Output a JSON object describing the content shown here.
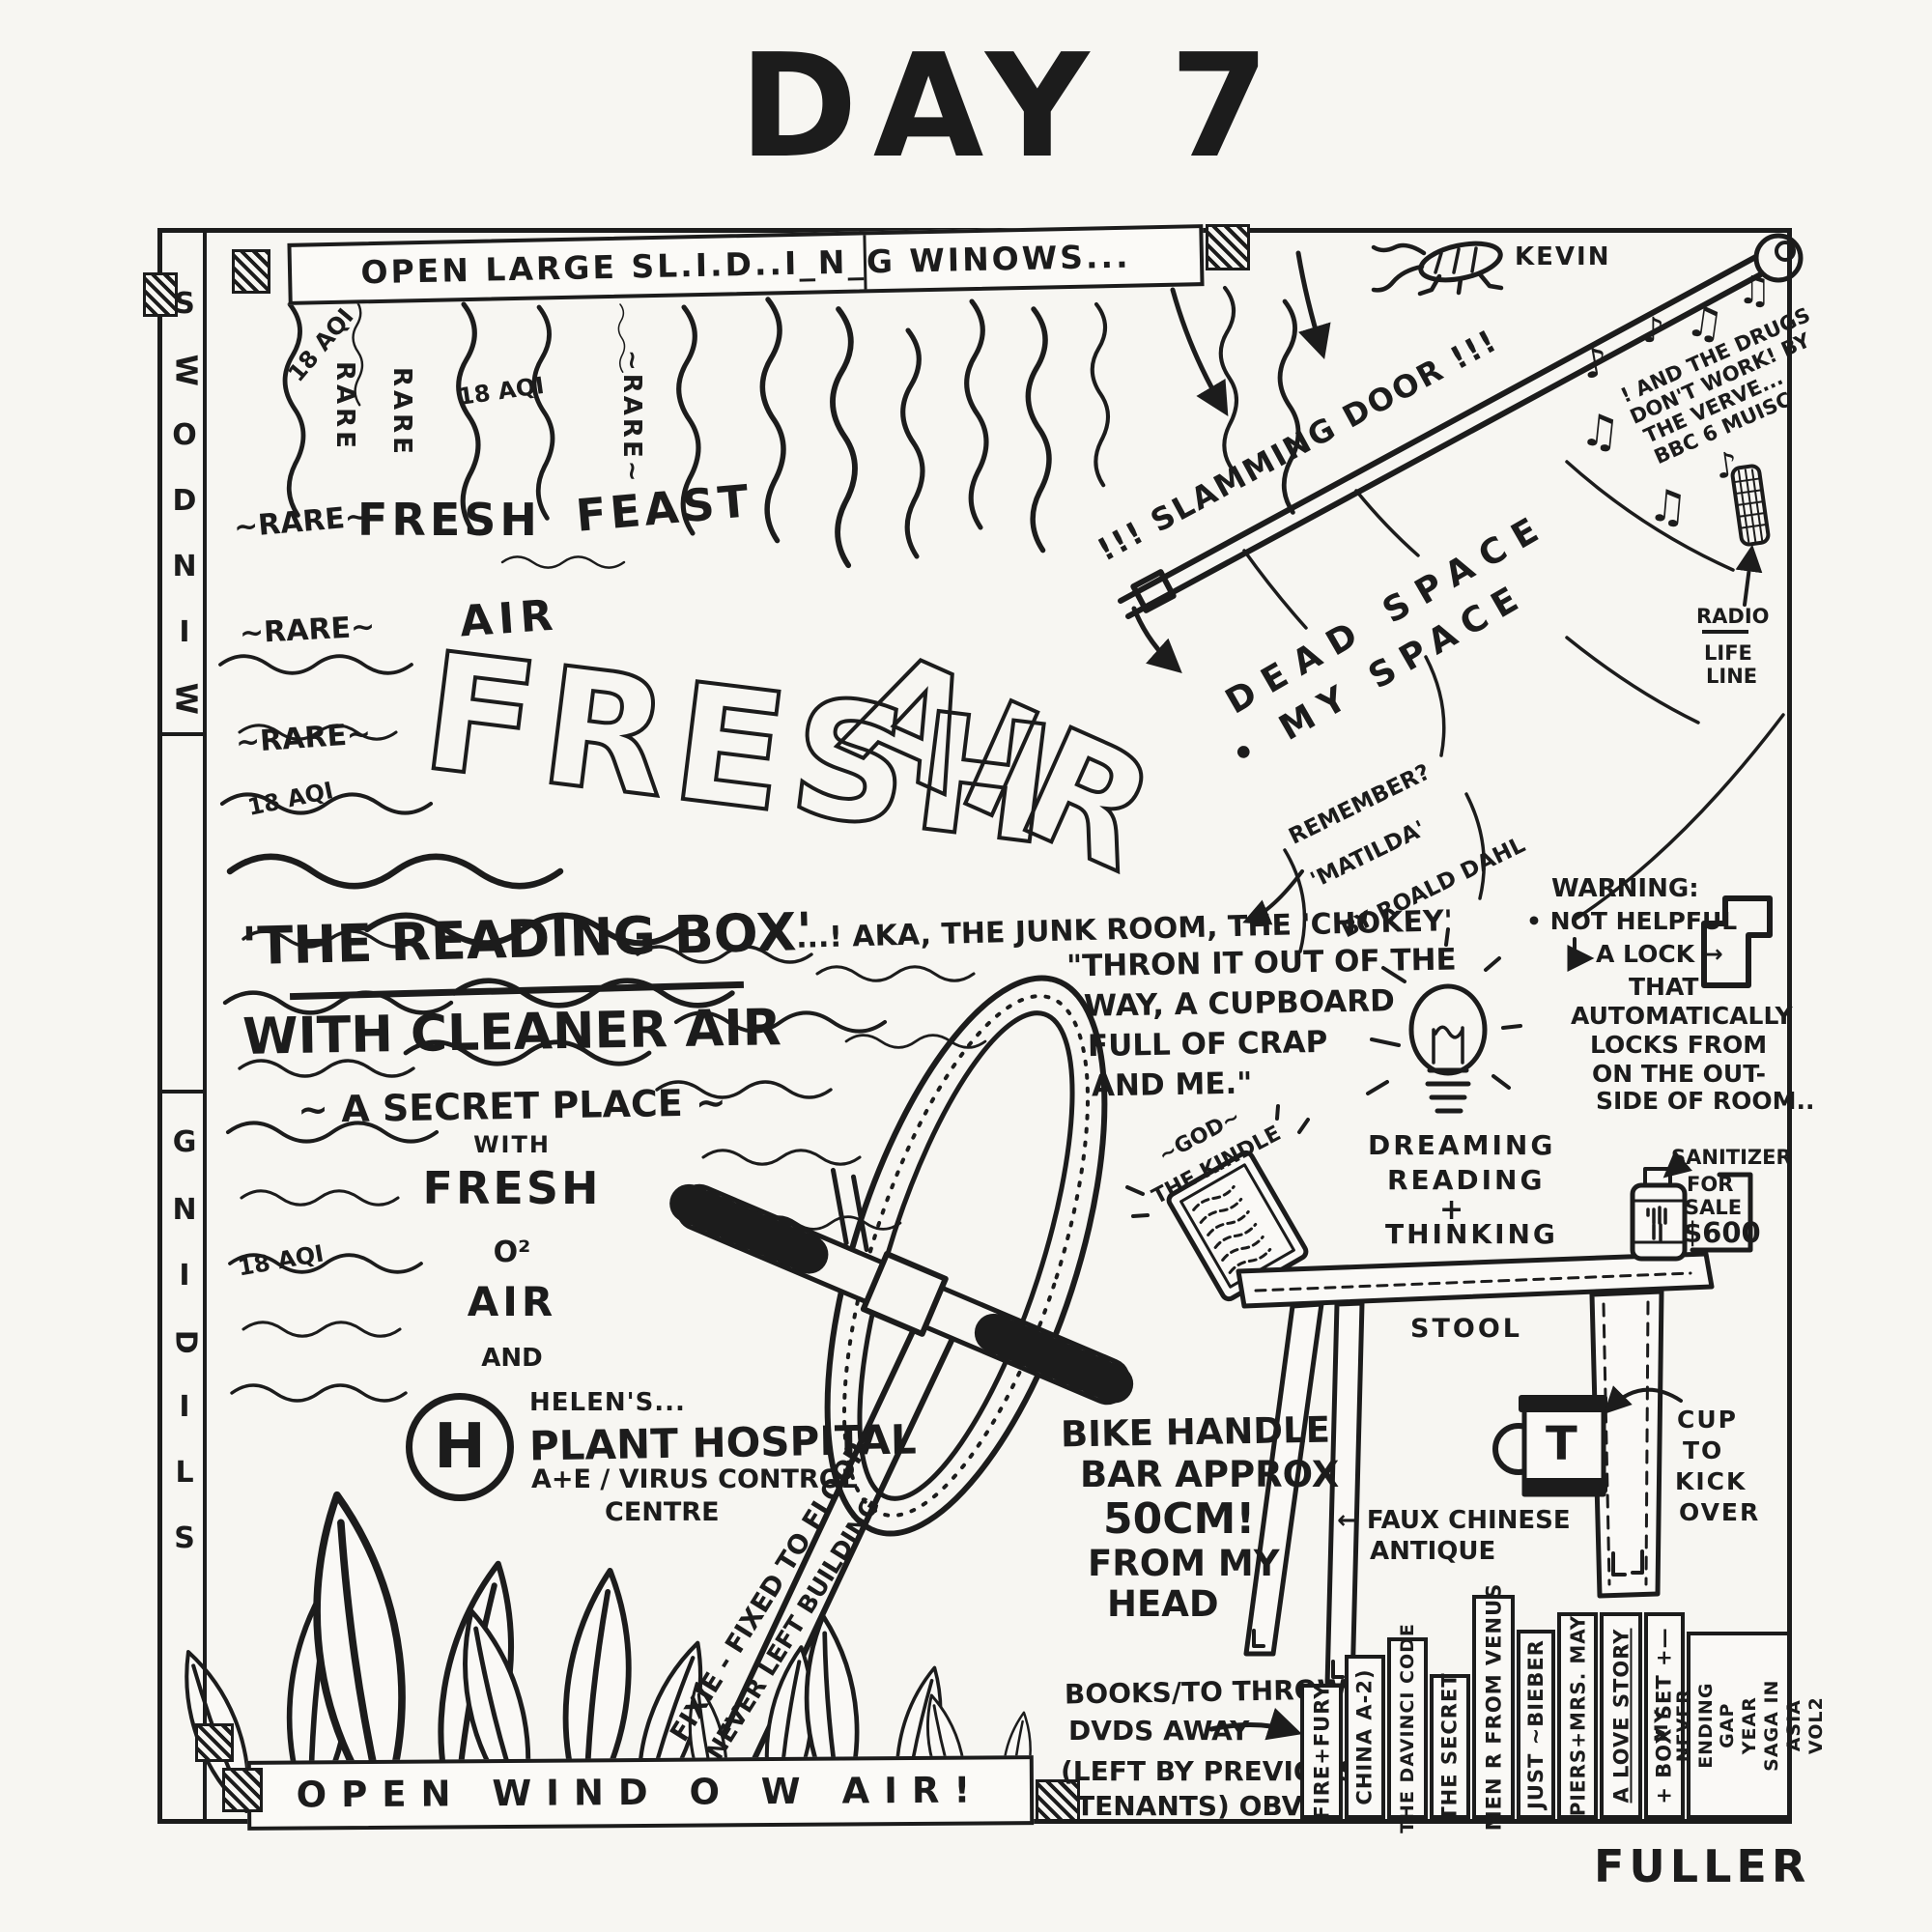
{
  "page": {
    "title": "DAY 7",
    "signature": "FULLER"
  },
  "colors": {
    "ink": "#1c1c1c",
    "paper": "#f7f6f2"
  },
  "window": {
    "top_banner": "OPEN LARGE SL.I.D..I_N_G WINOWS...",
    "bottom_banner": "OPEN WIND O W AIR!",
    "letters_windows": [
      "S",
      "W",
      "O",
      "D",
      "N",
      "I",
      "W"
    ],
    "letters_sliding": [
      "G",
      "N",
      "I",
      "D",
      "I",
      "L",
      "S"
    ]
  },
  "kevin": {
    "label": "KEVIN"
  },
  "door": {
    "label": "!!! SLAMMING DOOR !!!",
    "dead_space": "DEAD SPACE",
    "my_space": "• MY SPACE"
  },
  "music": {
    "l1": "! AND THE DRUGS",
    "l2": "DON'T WORK! BY",
    "l3": "THE VERVE...",
    "l4": "BBC 6 MUISC",
    "radio": "RADIO",
    "life": "LIFE",
    "line": "LINE",
    "note_single": "♪",
    "note_double": "♫"
  },
  "air": {
    "aqi": "18 AQI",
    "rare": "RARE",
    "rare_wavy": "~RARE~",
    "fresh_small": "FRESH",
    "air_small": "AIR",
    "feast": "FEAST",
    "fresh_big": "FRESH",
    "air_big": "AIR"
  },
  "reading_box": {
    "title": "'THE READING BOX'",
    "subtitle": "WITH CLEANER AIR",
    "tagline": "~ A SECRET PLACE ~",
    "with": "WITH",
    "fresh": "FRESH",
    "o2": "O²",
    "air": "AIR",
    "and": "AND"
  },
  "junk_room": {
    "aka": "...! AKA, THE JUNK ROOM, THE 'CHOKEY'",
    "q1": "\"THRON IT OUT OF THE",
    "q2": "WAY, A CUPBOARD",
    "q3": "FULL OF CRAP",
    "q4": "AND ME.\"",
    "m1": "REMEMBER?",
    "m2": "'MATILDA'",
    "m3": "BY ROALD DAHL"
  },
  "plant_hospital": {
    "h": "H",
    "helens": "HELEN'S...",
    "name": "PLANT HOSPITAL",
    "dept": "A+E / VIRUS CONTROL",
    "centre": "CENTRE"
  },
  "bike": {
    "fixie1": "FIXIE - FIXED TO FLOOR",
    "fixie2": "NEVER LEFT BUILDING",
    "h1": "BIKE HANDLE",
    "h2": "BAR APPROX",
    "h3": "50CM!",
    "h4": "FROM MY",
    "h5": "HEAD"
  },
  "ideas": {
    "l1": "DREAMING",
    "l2": "READING",
    "l3": "+",
    "l4": "THINKING"
  },
  "warning": {
    "l1": "WARNING:",
    "l2": "• NOT HELPFUL",
    "l3": "A LOCK →",
    "l4": "THAT",
    "l5": "AUTOMATICALLY",
    "l6": "LOCKS FROM",
    "l7": "ON THE OUT-",
    "l8": "SIDE OF ROOM.."
  },
  "kindle": {
    "l1": "~GOD~",
    "l2": "THE KINDLE"
  },
  "stool": {
    "label": "STOOL",
    "faux1": "← FAUX CHINESE",
    "faux2": "ANTIQUE"
  },
  "sanitizer": {
    "l1": "SANITIZER",
    "l2": "FOR",
    "l3": "SALE",
    "price": "$600"
  },
  "cup": {
    "letter": "T",
    "l1": "CUP",
    "l2": "TO",
    "l3": "KICK",
    "l4": "OVER"
  },
  "books": {
    "n1": "BOOKS/TO THROW",
    "n2": "DVDS AWAY",
    "n3": "(LEFT BY PREVIOUS",
    "n4": "TENANTS) OBVS.",
    "spines": [
      {
        "label": "FIRE+FURY"
      },
      {
        "label": "CHINA A-2)"
      },
      {
        "label": "THE DAVINCI CODE"
      },
      {
        "label": "THE SECRET"
      },
      {
        "label": "MEN R FROM VENUS"
      },
      {
        "label": "JUST ~BIEBER"
      },
      {
        "label": "PIERS+MRS. MAY"
      },
      {
        "label": "A LOVE STORY"
      },
      {
        "label": "+ BOX SET +—"
      },
      {
        "label": "MY NEVER ENDING GAP YEAR SAGA IN ASIA VOL2"
      }
    ]
  }
}
